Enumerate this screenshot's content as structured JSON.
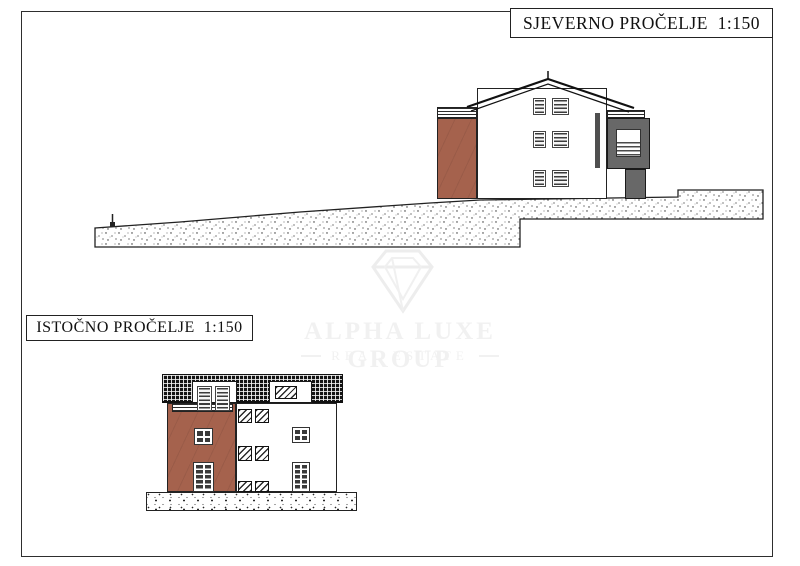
{
  "labels": {
    "north": "SJEVERNO PROČELJE  1:150",
    "east": "ISTOČNO PROČELJE  1:150"
  },
  "watermark": {
    "brand": "ALPHA LUXE GROUP",
    "tagline": "REAL ESTATE"
  },
  "colors": {
    "brick": "#a5624d",
    "tower_gray": "#686868",
    "roof_dark": "#141414",
    "ink": "#222222",
    "watermark": "#f1f1f1"
  }
}
